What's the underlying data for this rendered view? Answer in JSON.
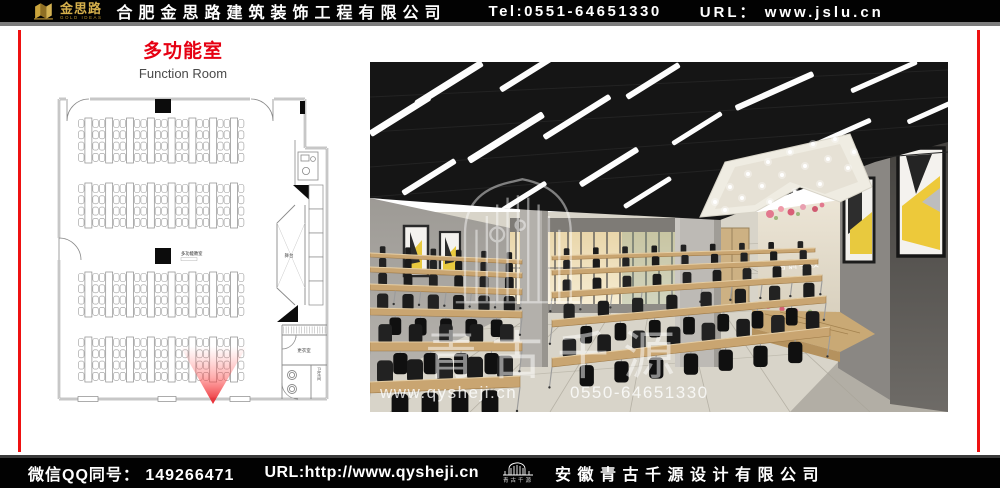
{
  "header": {
    "logo_text": "金思路",
    "logo_subtext": "GOLD IDEAS",
    "company_name": "合肥金思路建筑装饰工程有限公司",
    "tel": "Tel:0551-64651330",
    "url": "URL：  www.jslu.cn"
  },
  "slide": {
    "title_cn": "多功能室",
    "title_en": "Function Room"
  },
  "floor_plan": {
    "room_label": "多功能教室",
    "stage_label": "舞台",
    "changing_room_label": "更衣室",
    "toilet_label": "卫生间",
    "layout": {
      "table_bands": 4,
      "table_columns": 8,
      "chairs_per_side": 4
    }
  },
  "photo": {
    "sign_text": "培训学校",
    "watermark_logo_text": "青古千源",
    "watermark_url": "www.qysheji.cn",
    "watermark_phone": "0550-64651330"
  },
  "footer": {
    "qq_label": "微信QQ同号： 149266471",
    "url_label": "URL:http://www.qysheji.cn",
    "logo_text": "青古千源",
    "company_name": "安徽青古千源设计有限公司"
  },
  "colors": {
    "accent_red": "#e60012",
    "border_red": "#ee1111",
    "gold": "#d6b04c",
    "bar_black": "#020202"
  }
}
